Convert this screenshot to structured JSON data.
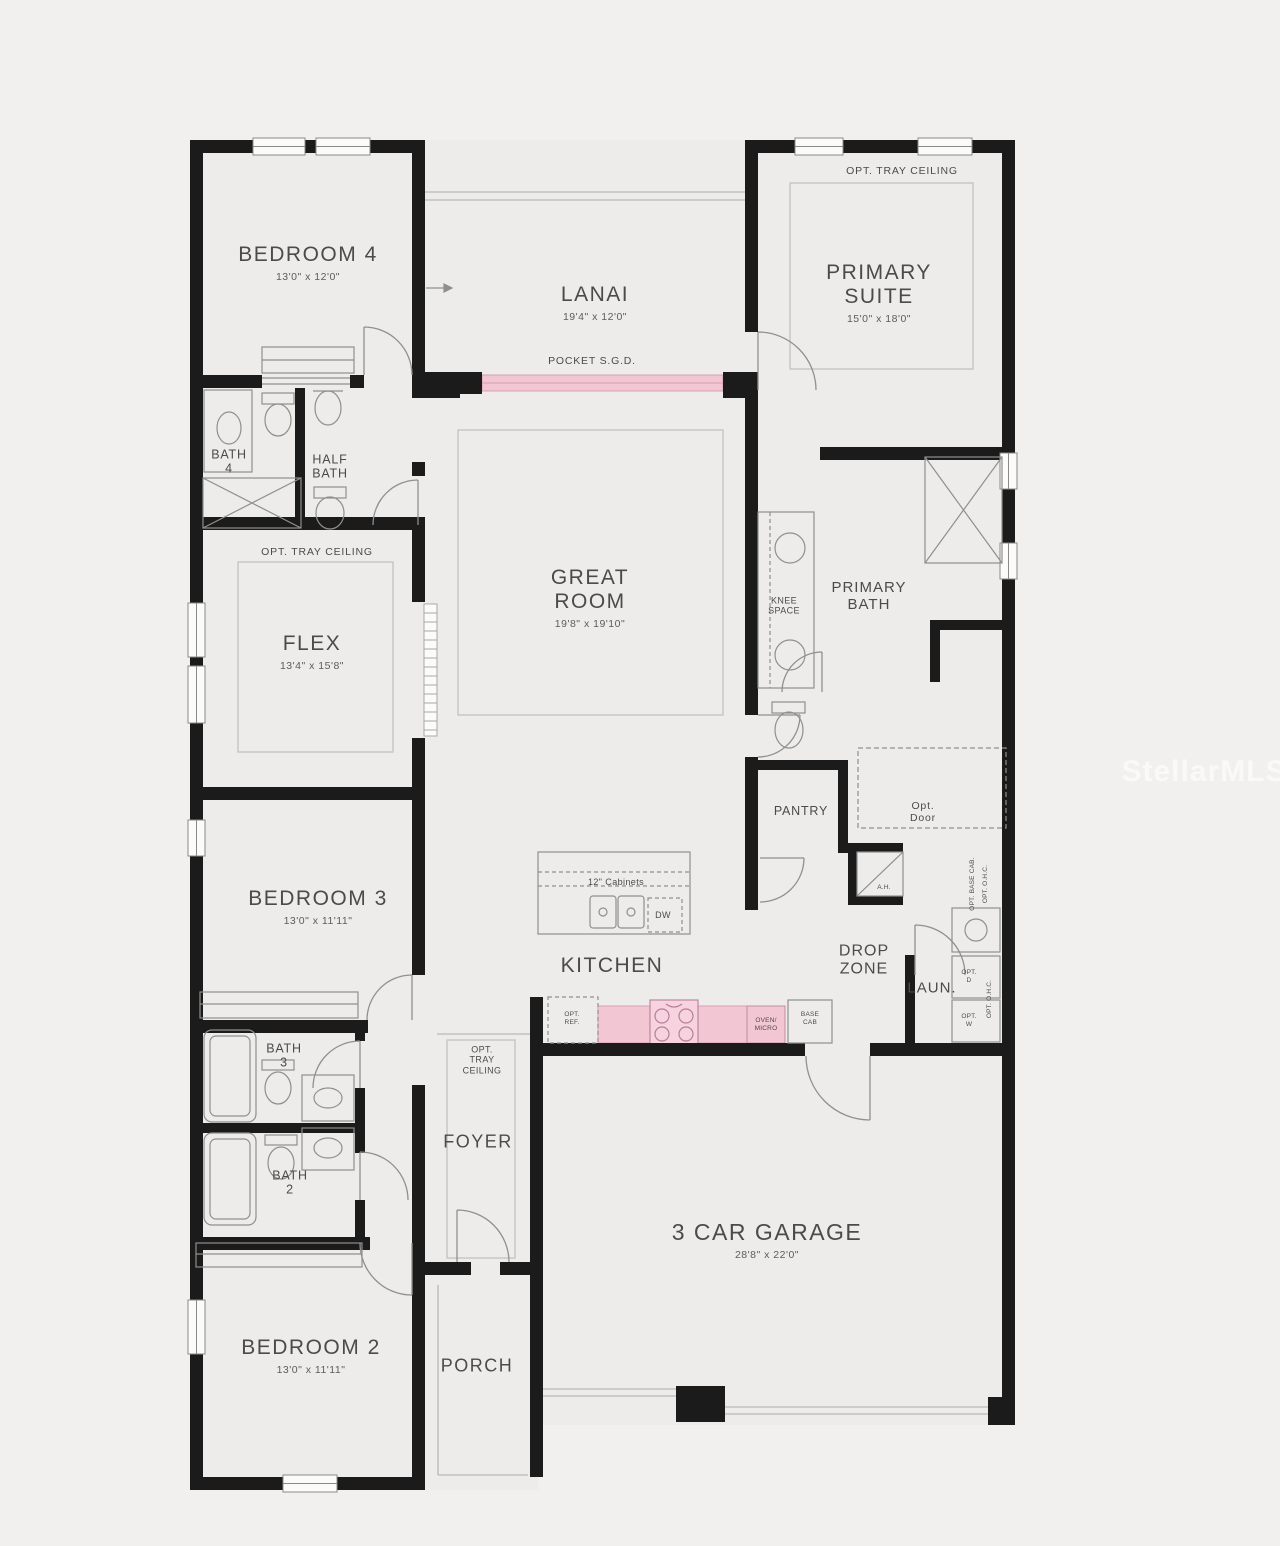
{
  "watermark": "StellarMLS",
  "shared": {
    "opt_tray_ceiling": "OPT. TRAY CEILING"
  },
  "rooms": {
    "bedroom4": {
      "name": "BEDROOM 4",
      "dims": "13'0\" x 12'0\""
    },
    "lanai": {
      "name": "LANAI",
      "dims": "19'4\" x 12'0\"",
      "door": "POCKET S.G.D."
    },
    "primary_suite": {
      "line1": "PRIMARY",
      "line2": "SUITE",
      "dims": "15'0\" x 18'0\""
    },
    "bath4": {
      "line1": "BATH",
      "line2": "4"
    },
    "half_bath": {
      "line1": "HALF",
      "line2": "BATH"
    },
    "great_room": {
      "line1": "GREAT",
      "line2": "ROOM",
      "dims": "19'8\" x 19'10\""
    },
    "flex": {
      "name": "FLEX",
      "dims": "13'4\" x 15'8\""
    },
    "primary_bath": {
      "line1": "PRIMARY",
      "line2": "BATH",
      "knee1": "KNEE",
      "knee2": "SPACE",
      "opt_door1": "Opt.",
      "opt_door2": "Door"
    },
    "pantry": {
      "name": "PANTRY"
    },
    "utility": {
      "ah": "A.H.",
      "drop1": "DROP",
      "drop2": "ZONE",
      "laun": "LAUN.",
      "opt_base_cab": "OPT. BASE CAB.",
      "opt_ohc": "OPT. O.H.C.",
      "opt_d1": "OPT.",
      "opt_d2": "D",
      "opt_w1": "OPT.",
      "opt_w2": "W"
    },
    "kitchen": {
      "name": "KITCHEN",
      "cabinets": "12\" Cabinets",
      "dw": "DW",
      "opt_ref1": "OPT.",
      "opt_ref2": "REF.",
      "oven1": "OVEN/",
      "oven2": "MICRO",
      "base1": "BASE",
      "base2": "CAB"
    },
    "bedroom3": {
      "name": "BEDROOM 3",
      "dims": "13'0\" x 11'11\""
    },
    "bath3": {
      "line1": "BATH",
      "line2": "3"
    },
    "bath2": {
      "line1": "BATH",
      "line2": "2"
    },
    "foyer": {
      "name": "FOYER",
      "opt1": "OPT.",
      "opt2": "TRAY",
      "opt3": "CEILING"
    },
    "garage": {
      "name": "3 CAR GARAGE",
      "dims": "28'8\" x 22'0\""
    },
    "bedroom2": {
      "name": "BEDROOM 2",
      "dims": "13'0\" x 11'11\""
    },
    "porch": {
      "name": "PORCH"
    }
  }
}
